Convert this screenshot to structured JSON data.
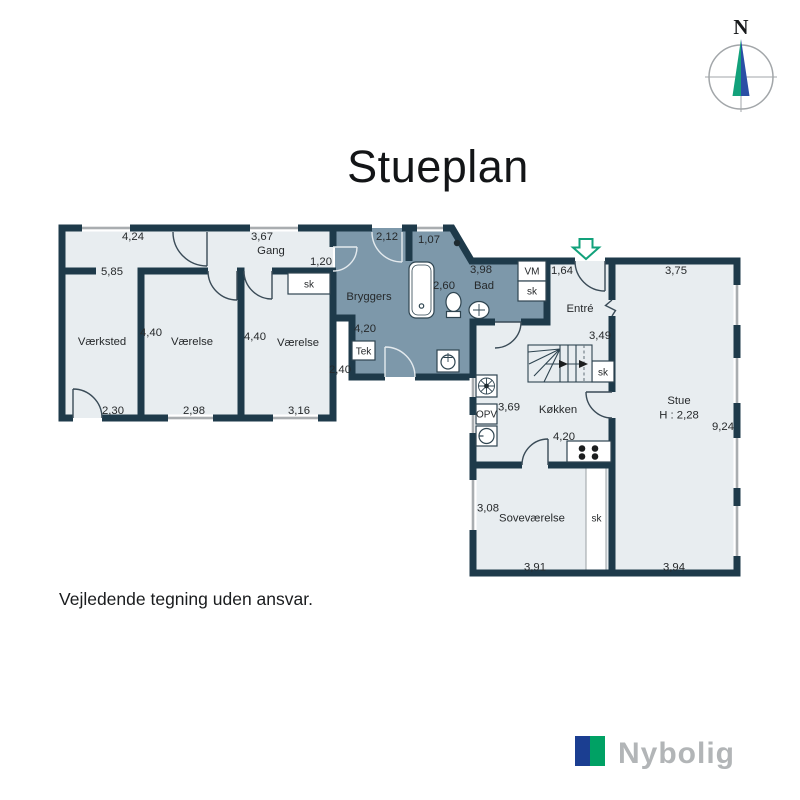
{
  "page": {
    "title": "Stueplan",
    "disclaimer": "Vejledende tegning uden ansvar."
  },
  "compass": {
    "north": "N"
  },
  "logo": {
    "brand": "Nybolig"
  },
  "colors": {
    "wall": "#1e3a4a",
    "room_fill": "#e8edf0",
    "wet_room_fill": "#7d98aa",
    "window_gray": "#a9adb0",
    "entrance_arrow_green": "#12a17b",
    "compass_green": "#12a17b",
    "compass_blue": "#2b4fa5",
    "logo_blue": "#1b3e91",
    "logo_green": "#00a164",
    "logo_text_gray": "#b2b5b7"
  },
  "floorplan": {
    "gang": {
      "label": "Gang",
      "top": "3,67",
      "door": "1,20",
      "closet": "sk"
    },
    "vaerksted": {
      "label": "Værksted",
      "top": "4,24",
      "mid": "5,85",
      "bottom": "2,30"
    },
    "vaerelse1": {
      "label": "Værelse",
      "side": "4,40",
      "bottom": "2,98"
    },
    "vaerelse2": {
      "label": "Værelse",
      "side": "4,40",
      "bottom": "3,16"
    },
    "bryggers": {
      "label": "Bryggers",
      "door_top": "2,12",
      "width": "4,20",
      "side": "2,40",
      "tek": "Tek"
    },
    "bad": {
      "label": "Bad",
      "window_top": "1,07",
      "width": "3,98",
      "mid": "2,60",
      "vm": "VM",
      "closet": "sk"
    },
    "entre": {
      "label": "Entré",
      "top": "1,64",
      "side": "3,49"
    },
    "stue": {
      "label": "Stue",
      "ceiling_height": "H : 2,28",
      "top": "3,75",
      "side": "9,24",
      "bottom": "3,94"
    },
    "koekken": {
      "label": "Køkken",
      "side": "3,69",
      "bottom": "4,20",
      "opv": "OPV",
      "stair_closet": "sk"
    },
    "sovevaerelse": {
      "label": "Soveværelse",
      "side": "3,08",
      "bottom": "3,91",
      "closet": "sk"
    }
  }
}
